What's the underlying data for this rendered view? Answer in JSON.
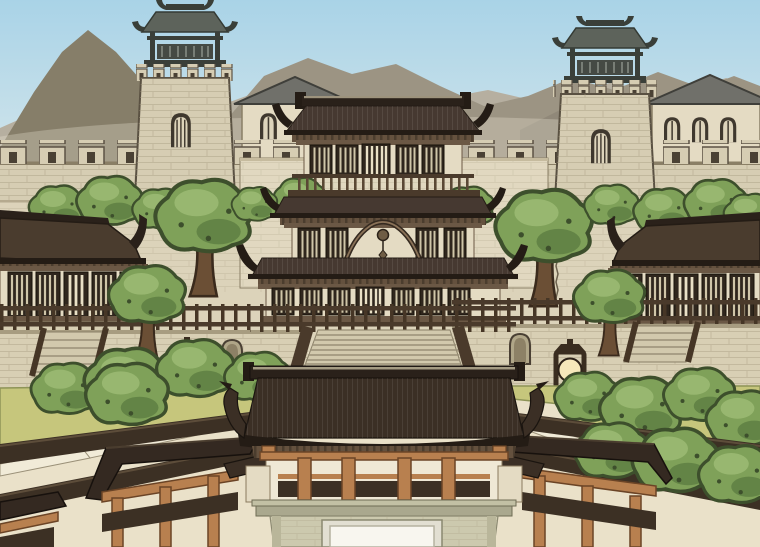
{
  "scene": {
    "description": "Webtoon-style illustration of a walled ancient East Asian palace complex: a crenellated outer city wall with two watchtowers, a multi-tiered central palace hall, side pavilions, stone terraces with a grand staircase and glowing stone lanterns, tree-filled gardens with walkway railings, and a large dark-roofed gatehouse with orange pillars in the foreground, hazy mountains behind under a pale blue sky",
    "elements": [
      "sky",
      "mountains",
      "outer-wall",
      "watchtower-left",
      "watchtower-right",
      "gabled-house-left",
      "gabled-house-right",
      "inner-walls",
      "background-trees",
      "pavilion-left",
      "pavilion-right",
      "central-palace",
      "grand-staircase",
      "terraces",
      "stone-lantern-left",
      "stone-lantern-right",
      "garden-left",
      "garden-right",
      "walkway-railings",
      "corridor-gate-left",
      "corridor-gate-right",
      "main-gatehouse"
    ]
  },
  "palette": {
    "skyTop": "#a9d3e7",
    "skyMid": "#c9e1ea",
    "skyHorizon": "#e6efec",
    "mountainFar": "#b6afa0",
    "mountainMid": "#9c9483",
    "mountainNear": "#867e69",
    "mountainRight": "#908879",
    "wallStone": "#d6cdb3",
    "wallEdge": "#8a7f66",
    "merlonHole": "#4a4134",
    "panelWall": "#dcd3ba",
    "innerWall": "#e1d8c0",
    "towerRoof": "#5d635b",
    "towerRoofDark": "#3a3f39",
    "towerInner": "#454a44",
    "houseRoof": "#70706a",
    "cream": "#e4dbc3",
    "roofBrown": "#463931",
    "roofDark": "#3b2f25",
    "roofDarker": "#241c15",
    "roofRidge": "#2a211a",
    "corridorRoof": "#342921",
    "pavRoof": "#4a3c2e",
    "timber": "#6b5845",
    "timberDark": "#4a3a2b",
    "bracket": "#64513e",
    "lattice": "#2f261d",
    "latticeSlit": "#cfc5a8",
    "latticeDoorSlit": "#e9e0c6",
    "pillarOrange": "#b8804f",
    "pillarOrangeDark": "#6b4426",
    "courtyard": "#eae1c9",
    "terrace": "#d8cfb4",
    "terraceEdge": "#a79c80",
    "stair": "#d2c9ad",
    "stairLine": "#9a9078",
    "grass": "#c6c67c",
    "grassEdge": "#8e9457",
    "treeMid": "#7fa159",
    "treeLight": "#9cbb74",
    "treeDark": "#5d7d41",
    "treeOutline": "#3d4f2c",
    "trunk": "#6b4f35",
    "curb": "#f1ebd8",
    "gateBase": "#ccc9ae",
    "cornice": "#aaa88e",
    "doorFrame": "#e2dfd2",
    "doorWhite": "#f8f6ef",
    "lanternGlow": "#f6e8bb",
    "lanternFrame": "#3a2d20",
    "railDark": "#3c3024",
    "balconyLight": "#efe8d5",
    "postDark": "#463626",
    "baluster": "#5a4835"
  }
}
